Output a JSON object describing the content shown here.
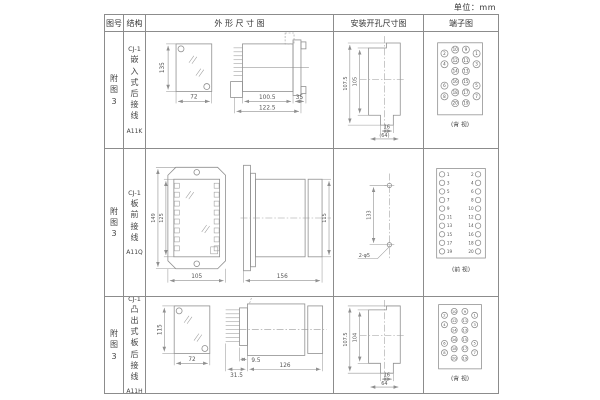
{
  "unit_label": "单位：mm",
  "header": {
    "fig_no": "图号",
    "structure": "结构",
    "outline": "外 形 尺 寸 图",
    "install": "安装开孔尺寸图",
    "terminal": "端子图"
  },
  "rows": [
    {
      "fig": "附图3",
      "series": "CJ-1",
      "mounting": "嵌入式后接线",
      "model": "A11K",
      "outline": {
        "front_h": "135",
        "front_w": "72",
        "side_d1": "100.5",
        "side_d2": "122.5",
        "side_d3": "35"
      },
      "install": {
        "v_outer": "107.5",
        "v_inner": "105",
        "w_slot": "16",
        "w_total": "(64)"
      },
      "terminal": {
        "caption": "(背 视)",
        "view": "rear",
        "rows": [
          [
            "2",
            "10",
            "9",
            "1"
          ],
          [
            "4",
            "12",
            "11",
            "3"
          ],
          [
            "",
            "14",
            "13",
            ""
          ],
          [
            "6",
            "16",
            "15",
            "5"
          ],
          [
            "8",
            "18",
            "17",
            "7"
          ],
          [
            "",
            "20",
            "19",
            ""
          ]
        ]
      }
    },
    {
      "fig": "附图3",
      "series": "CJ-1",
      "mounting": "板前接线",
      "model": "A11Q",
      "outline": {
        "front_h": "149",
        "front_h2": "125",
        "front_w": "105",
        "side_d1": "156",
        "side_h": "115"
      },
      "install": {
        "v_dim": "133",
        "hole_label": "2-φ5"
      },
      "terminal": {
        "caption": "(前 视)",
        "view": "front",
        "left": [
          "1",
          "3",
          "5",
          "7",
          "9",
          "11",
          "13",
          "15",
          "17",
          "19"
        ],
        "right": [
          "2",
          "4",
          "6",
          "8",
          "10",
          "12",
          "14",
          "16",
          "18",
          "20"
        ]
      }
    },
    {
      "fig": "附图3",
      "series": "CJ-1",
      "mounting": "凸出式板后接线",
      "model": "A11H",
      "outline": {
        "front_h": "115",
        "front_w": "72",
        "side_d1": "31.5",
        "side_d2": "9.5",
        "side_d3": "126"
      },
      "install": {
        "v_outer": "107.5",
        "v_inner": "104",
        "w_slot": "16",
        "w_total": "64"
      },
      "terminal": {
        "caption": "(背 视)",
        "view": "rear",
        "rows": [
          [
            "2",
            "10",
            "9",
            "1"
          ],
          [
            "4",
            "12",
            "11",
            "3"
          ],
          [
            "",
            "14",
            "13",
            ""
          ],
          [
            "6",
            "16",
            "15",
            "5"
          ],
          [
            "8",
            "18",
            "17",
            "7"
          ],
          [
            "",
            "20",
            "19",
            ""
          ]
        ]
      }
    }
  ]
}
